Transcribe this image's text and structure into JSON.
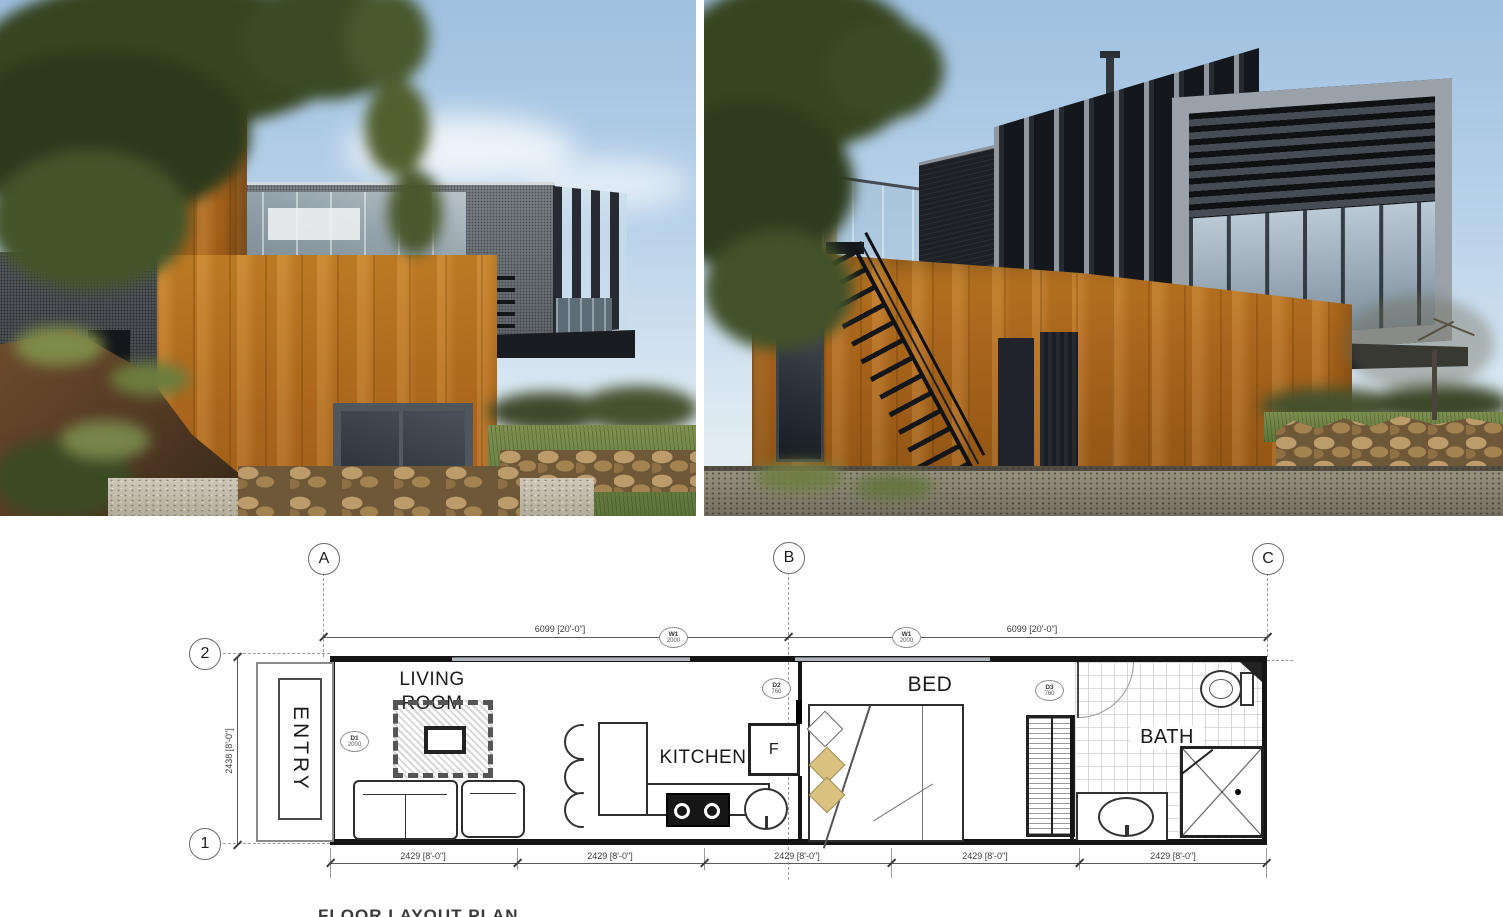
{
  "plan": {
    "grid": {
      "cols": [
        "A",
        "B",
        "C"
      ],
      "rows": [
        "2",
        "1"
      ]
    },
    "dims": {
      "top": [
        "6099 [20'-0\"]",
        "6099 [20'-0\"]"
      ],
      "left": "2438 [8'-0\"]",
      "bottom": [
        "2429 [8'-0\"]",
        "2429 [8'-0\"]",
        "2429 [8'-0\"]",
        "2429 [8'-0\"]",
        "2429 [8'-0\"]"
      ]
    },
    "tags": {
      "w1a": {
        "id": "W1",
        "val": "2000"
      },
      "w1b": {
        "id": "W1",
        "val": "2000"
      },
      "d1": {
        "id": "D1",
        "val": "2000"
      },
      "d2": {
        "id": "D2",
        "val": "760"
      },
      "d3": {
        "id": "D3",
        "val": "760"
      }
    },
    "rooms": {
      "entry": "ENTRY",
      "living": "LIVING ROOM",
      "kitchen": "KITCHEN",
      "bed": "BED",
      "bath": "BATH",
      "fridge": "F"
    },
    "title": "FLOOR LAYOUT PLAN"
  },
  "colors": {
    "corten": "#b26a1c",
    "cladding_dark": "#1d2126",
    "mesh_grey": "#6e7478",
    "frame_grey": "#9aa1a9",
    "sky_top": "#9fc0e0",
    "sky_bottom": "#e9f0f5",
    "plan_line": "#5a5a5a",
    "pillow_gold": "#d9c27f"
  }
}
